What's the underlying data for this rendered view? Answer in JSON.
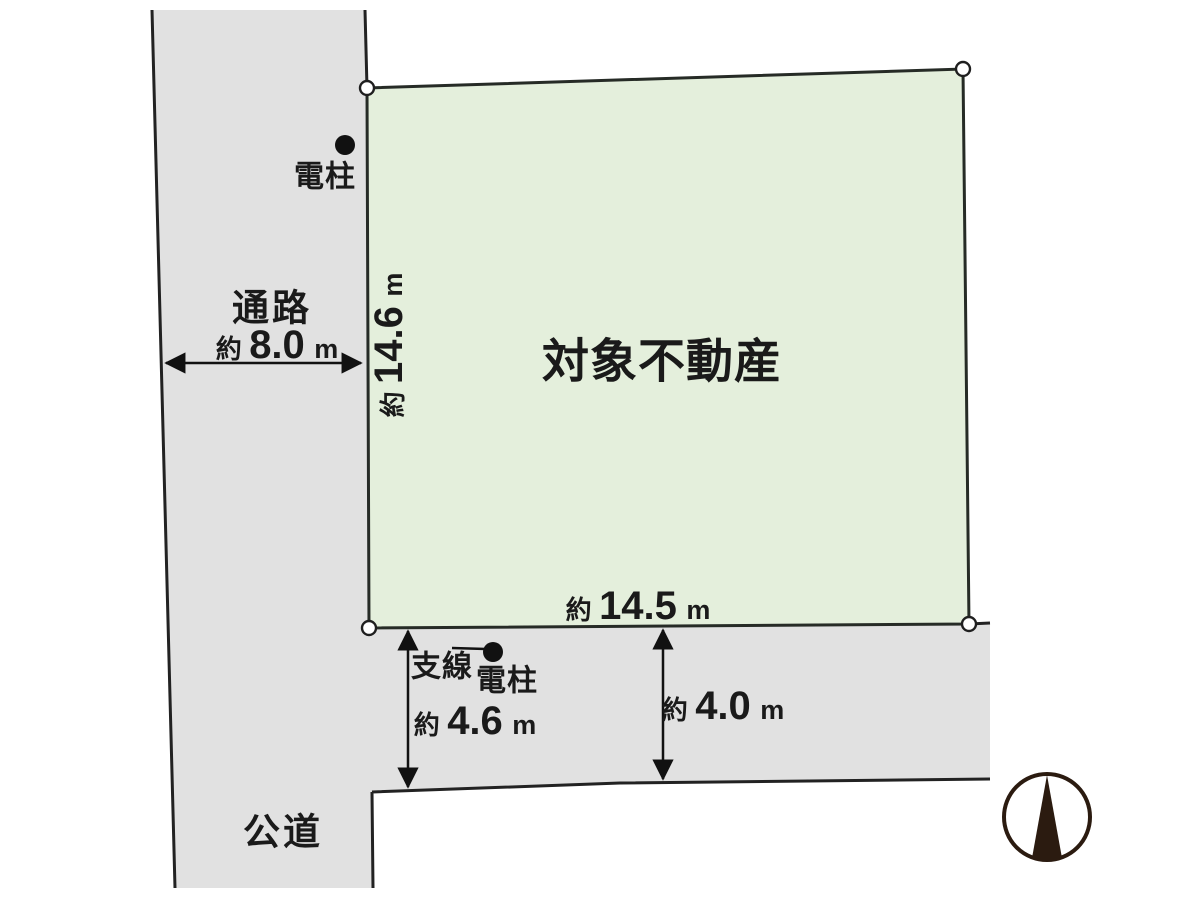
{
  "colors": {
    "road_fill": "#e1e1e1",
    "parcel_fill": "#e4efdc",
    "line": "#222222",
    "compass": "#2b1b10"
  },
  "parcel": {
    "name": "対象不動産",
    "west_dim": {
      "prefix": "約",
      "value": "14.6",
      "unit": "m"
    },
    "south_dim": {
      "prefix": "約",
      "value": "14.5",
      "unit": "m"
    }
  },
  "passage": {
    "label": "通路",
    "width": {
      "prefix": "約",
      "value": "8.0",
      "unit": "m"
    }
  },
  "public_road": {
    "label": "公道"
  },
  "south_road": {
    "west_width": {
      "prefix": "約",
      "value": "4.6",
      "unit": "m"
    },
    "east_width": {
      "prefix": "約",
      "value": "4.0",
      "unit": "m"
    }
  },
  "poles": {
    "north": {
      "label": "電柱"
    },
    "south": {
      "label": "電柱",
      "anchor_label": "支線"
    }
  },
  "compass": {
    "label": "N"
  }
}
